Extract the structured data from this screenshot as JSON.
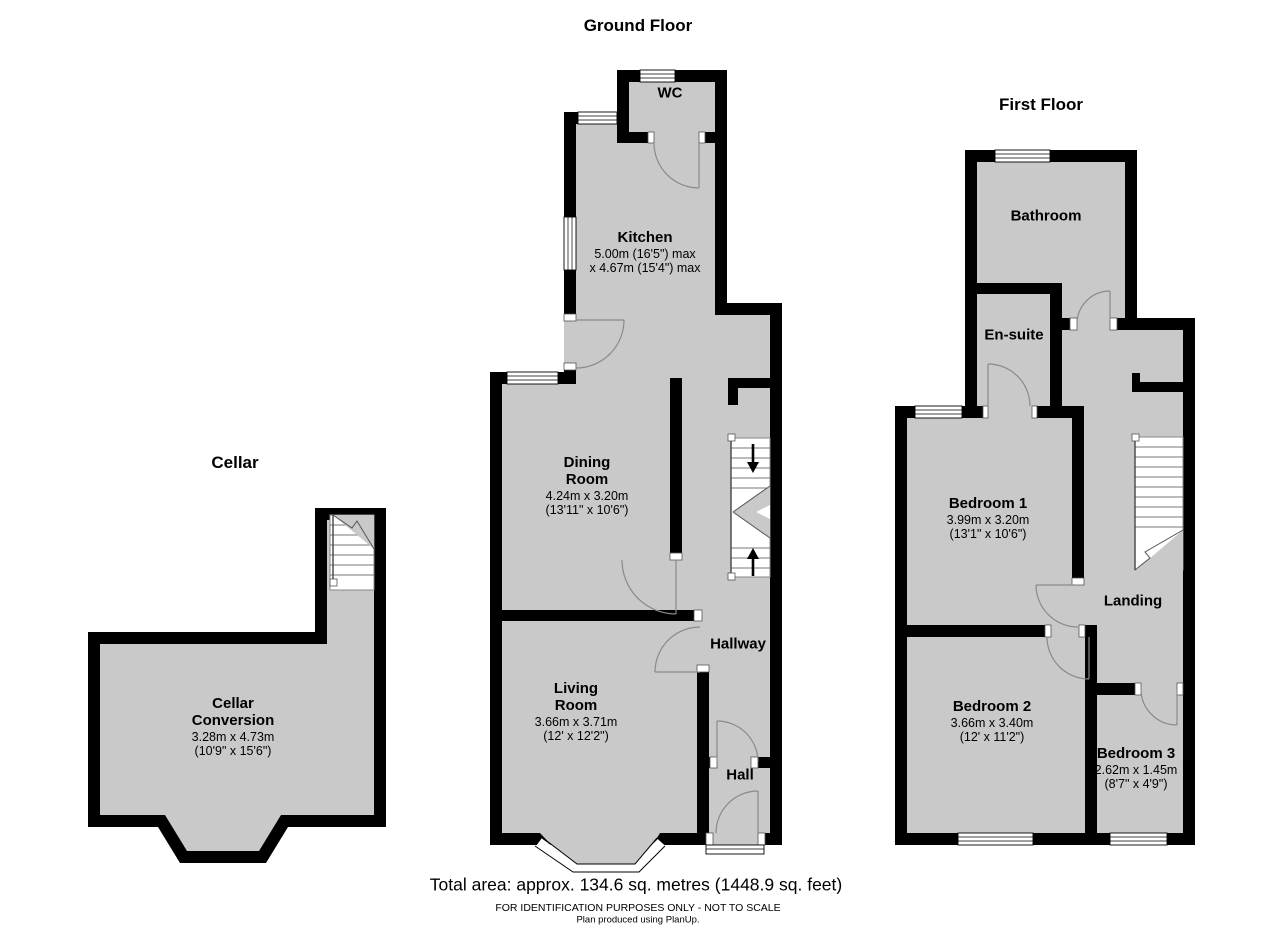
{
  "colors": {
    "room_fill": "#c9c9c9",
    "wall": "#000000",
    "door_arc": "#8a8a8a"
  },
  "floors": {
    "ground": {
      "title": "Ground Floor",
      "rooms": {
        "wc": {
          "name": "WC"
        },
        "kitchen": {
          "name": "Kitchen",
          "dim1": "5.00m (16'5\") max",
          "dim2": "x 4.67m (15'4\") max"
        },
        "dining": {
          "name1": "Dining",
          "name2": "Room",
          "dim1": "4.24m x 3.20m",
          "dim2": "(13'11\" x 10'6\")"
        },
        "living": {
          "name1": "Living",
          "name2": "Room",
          "dim1": "3.66m x 3.71m",
          "dim2": "(12' x 12'2\")"
        },
        "hallway": {
          "name": "Hallway"
        },
        "hall": {
          "name": "Hall"
        }
      }
    },
    "first": {
      "title": "First Floor",
      "rooms": {
        "bathroom": {
          "name": "Bathroom"
        },
        "ensuite": {
          "name": "En-suite"
        },
        "bedroom1": {
          "name": "Bedroom 1",
          "dim1": "3.99m x 3.20m",
          "dim2": "(13'1\" x 10'6\")"
        },
        "landing": {
          "name": "Landing"
        },
        "bedroom2": {
          "name": "Bedroom 2",
          "dim1": "3.66m x 3.40m",
          "dim2": "(12' x 11'2\")"
        },
        "bedroom3": {
          "name": "Bedroom 3",
          "dim1": "2.62m x 1.45m",
          "dim2": "(8'7\" x 4'9\")"
        }
      }
    },
    "cellar": {
      "title": "Cellar",
      "rooms": {
        "cellar_conversion": {
          "name1": "Cellar",
          "name2": "Conversion",
          "dim1": "3.28m x 4.73m",
          "dim2": "(10'9\" x 15'6\")"
        }
      }
    }
  },
  "footer": {
    "total_area": "Total area: approx. 134.6 sq. metres (1448.9 sq. feet)",
    "disclaimer": "FOR IDENTIFICATION PURPOSES ONLY - NOT TO SCALE",
    "credit": "Plan produced using PlanUp."
  }
}
